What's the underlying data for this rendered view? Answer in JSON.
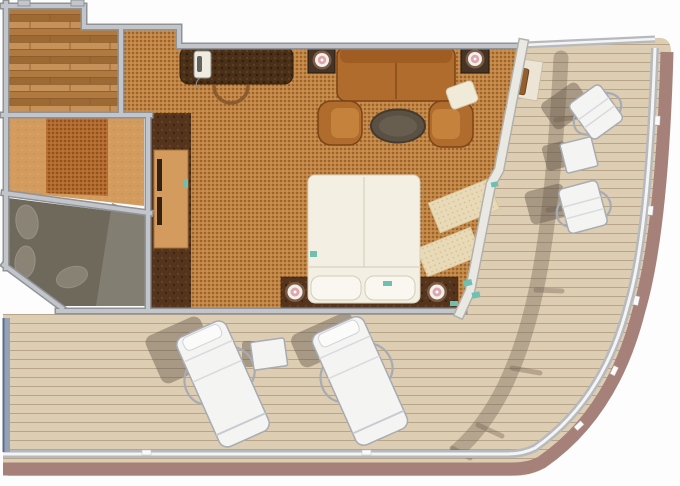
{
  "title": "Cruise suite floor plan with wrap-around balcony",
  "rooms": [
    {
      "name": "entry-foyer",
      "floor": "wood"
    },
    {
      "name": "dressing-area",
      "floor": "tan-carpet"
    },
    {
      "name": "bathroom",
      "floor": "grey",
      "fixtures": 3
    },
    {
      "name": "living-bedroom",
      "floor": "carpet"
    },
    {
      "name": "wraparound-balcony",
      "floor": "deck-planks"
    }
  ],
  "furniture": {
    "bed": 1,
    "pillows": 2,
    "nightstand_lamps": 2,
    "sofa": 1,
    "armchairs": 2,
    "coffee_table": 1,
    "side_table_lamps": 2,
    "desk": 1,
    "desk_phone": 1,
    "desk_chair": 1,
    "wardrobe_cabinet": 1,
    "area_rugs": 2,
    "cushion": 1,
    "balcony_chairs": 2,
    "balcony_side_tables": 2,
    "sun_loungers": 2,
    "balcony_bench": 1
  },
  "colors": {
    "bg": "#fdfdfd",
    "wall": "#c2c5c9",
    "wall_edge": "#8f9297",
    "carpet": "#c28544",
    "carpet_dot": "#7e4c1e",
    "wood": "#b0793f",
    "deck": "#ddcdb2",
    "deck_line": "#b7a489",
    "rail_mauve": "#a5817a",
    "rail_grey": "#b6b9be",
    "rail_white": "#f4f4f2",
    "rail_blue": "#95a1b6",
    "bath": "#6f695c",
    "bath_light": "#868274",
    "bath_oval": "#a29b8c",
    "tan": "#d39c5e",
    "furniture_brown": "#b06c2c",
    "furniture_dark": "#7c4517",
    "desk_brown": "#4a3018",
    "table_dark": "#453325",
    "coffee": "#5b5044",
    "bed": "#f3efe2",
    "pillow": "#f9f7ef",
    "rug": "#e9dab7",
    "lamp_pink": "#dfa7ab",
    "white_furn": "#f4f4f2",
    "chair_frame": "#a7abb2",
    "teal": "#6fc0b0",
    "shadow": "rgba(95,82,68,0.42)"
  }
}
